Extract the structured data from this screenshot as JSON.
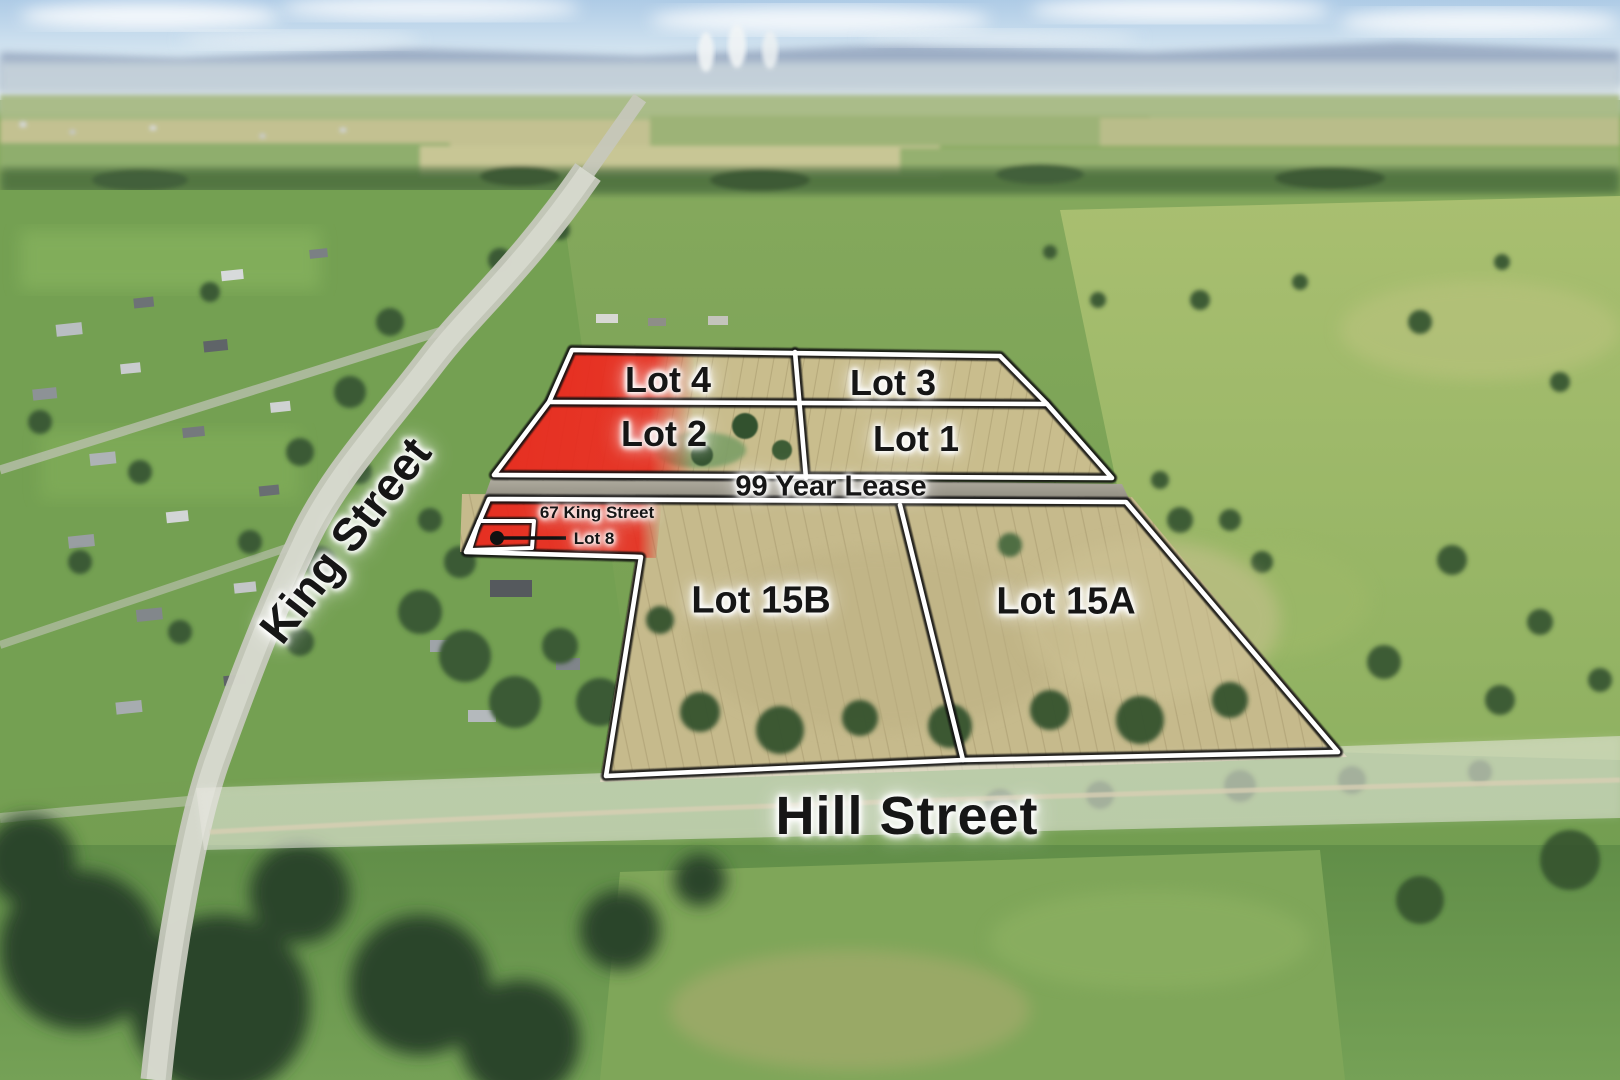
{
  "scene": {
    "description": "Aerial drone photograph of rural township land-for-sale with lot boundary overlays",
    "road_note": "99 Year Lease"
  },
  "lots": [
    {
      "id": "4",
      "label": "Lot 4",
      "status": "highlighted-red"
    },
    {
      "id": "3",
      "label": "Lot 3",
      "status": "available"
    },
    {
      "id": "2",
      "label": "Lot 2",
      "status": "highlighted-red"
    },
    {
      "id": "1",
      "label": "Lot 1",
      "status": "available"
    },
    {
      "id": "8",
      "label": "Lot 8",
      "address": "67 King Street",
      "status": "highlighted-red"
    },
    {
      "id": "15B",
      "label": "Lot 15B",
      "status": "available"
    },
    {
      "id": "15A",
      "label": "Lot 15A",
      "status": "available"
    }
  ],
  "streets": {
    "king": "King Street",
    "hill": "Hill Street"
  },
  "colors": {
    "sold_red": "#e8281c",
    "boundary_white": "#ffffff",
    "boundary_shadow": "#141414",
    "label_text": "#161616",
    "label_glow": "#ffffff",
    "field_tan": "#c9bd8d",
    "road_grey": "#a49e93"
  }
}
